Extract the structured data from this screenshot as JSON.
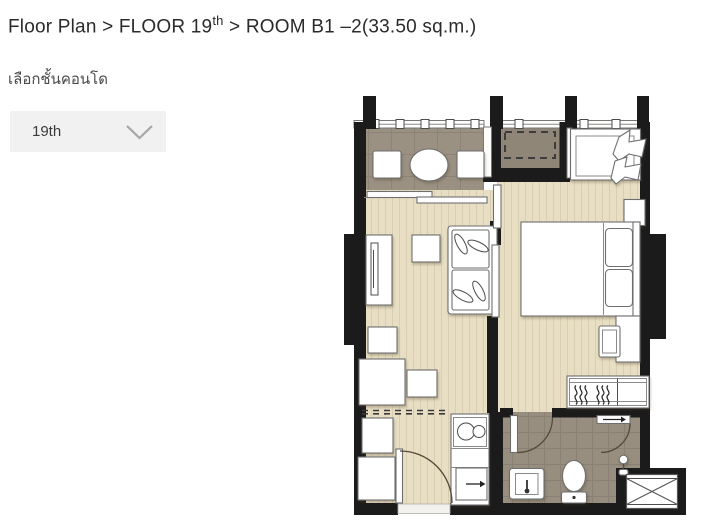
{
  "breadcrumb": {
    "pre": "Floor Plan > FLOOR 19",
    "sup": "th",
    "post": " > ROOM B1 –2(33.50 sq.m.)"
  },
  "floor_selector": {
    "label": "เลือกชั้นคอนโด",
    "value": "19th"
  },
  "colors": {
    "wall": "#1b1b1b",
    "wood-floor": "#e8dec3",
    "wood-line": "#d9ceb2",
    "balcony-floor": "#9b9183",
    "balcony-line": "#8d8376",
    "ac-floor": "#8f8678",
    "bath-floor": "#988e80",
    "bath-line": "#8a8073",
    "dropdown-bg": "#f1f1f1",
    "text-dark": "#2b2b2b",
    "text-gray": "#4a4a4a",
    "chevron": "#a6a6a6"
  }
}
